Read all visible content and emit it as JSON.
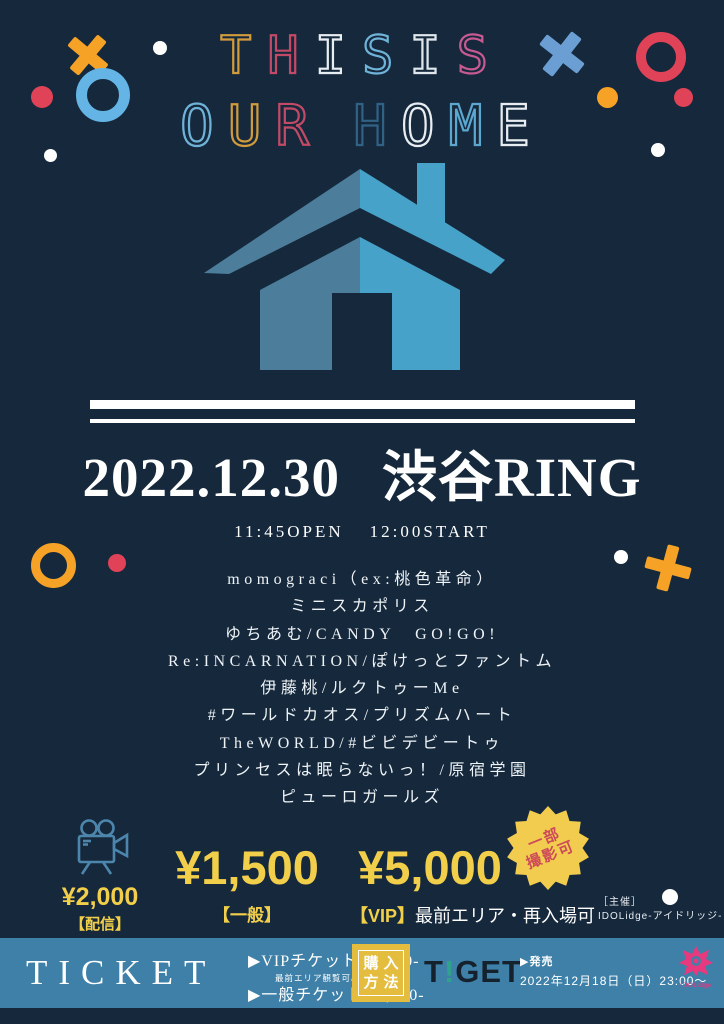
{
  "palette": {
    "bg": "#16293c",
    "white": "#ffffff",
    "yellow": "#f2cf4a",
    "red": "#e04358",
    "orange": "#f5a227",
    "lightblue": "#64b5e6",
    "steelblue": "#6b9fd4",
    "bar_blue": "#3e80a8",
    "house_left": "#4c7e9b",
    "house_right": "#47a2c9",
    "badge_yellow": "#f2cc4e",
    "badge_red": "#cc4a5a",
    "tiget_dark": "#15222e",
    "tiget_teal": "#2fa18c",
    "pink": "#e6397e",
    "camera_blue": "#4d86ad",
    "purchase_yellow": "#e4bd3e"
  },
  "title": {
    "line1": [
      {
        "ch": "T",
        "color": "#d29b3c"
      },
      {
        "ch": "H",
        "color": "#c34a66"
      },
      {
        "ch": "I",
        "color": "#e8edf2"
      },
      {
        "ch": "S",
        "color": "#6fb3d9"
      },
      {
        "ch": "I",
        "color": "#dfe6ec"
      },
      {
        "ch": "S",
        "color": "#c75a93"
      }
    ],
    "line2": [
      {
        "ch": "O",
        "color": "#6fb3d9"
      },
      {
        "ch": "U",
        "color": "#d29b3c"
      },
      {
        "ch": "R",
        "color": "#c34a66"
      },
      {
        "ch": " ",
        "color": ""
      },
      {
        "ch": "H",
        "color": "#2f6285"
      },
      {
        "ch": "O",
        "color": "#e8edf2"
      },
      {
        "ch": "M",
        "color": "#5ba7cf"
      },
      {
        "ch": "E",
        "color": "#e8edf2"
      }
    ]
  },
  "event": {
    "date": "2022.12.30",
    "venue": "渋谷RING",
    "open": "11:45OPEN",
    "start": "12:00START"
  },
  "lineup": {
    "acts": [
      "momograci（ex:桃色革命）",
      "ミニスカポリス",
      "ゆちあむ/CANDY　GO!GO!",
      "Re:INCARNATION/ぽけっとファントム",
      "伊藤桃/ルクトゥーMe",
      "#ワールドカオス/プリズムハート",
      "TheWORLD/#ビビデビートゥ",
      "プリンセスは眠らないっ！/原宿学園",
      "ピューロガールズ"
    ]
  },
  "pricing": {
    "stream": {
      "price": "¥2,000",
      "label": "【配信】",
      "note": "アーカイブ2週間"
    },
    "general": {
      "price": "¥1,500",
      "label": "【一般】"
    },
    "vip": {
      "price": "¥5,000",
      "tag": "【VIP】",
      "desc": "最前エリア・再入場可"
    },
    "badge": {
      "line1": "一部",
      "line2": "撮影可"
    },
    "organizer": {
      "label": "［主催］",
      "name": "IDOLidge-アイドリッジ-"
    }
  },
  "ticket_bar": {
    "title": "TICKET",
    "vip": {
      "label": "▶VIPチケット ¥5,000-",
      "note": "最前エリア観覧可/再入場可"
    },
    "general": {
      "label": "▶一般チケット ¥1,500-"
    },
    "purchase": {
      "line1": "購入",
      "line2": "方法"
    },
    "tiget": {
      "t": "T",
      "i": "!",
      "get": "GET"
    },
    "sale": {
      "label": "▶発売",
      "date": "2022年12月18日（日）23:00～"
    },
    "idolidge_label": "IDOLidge"
  }
}
